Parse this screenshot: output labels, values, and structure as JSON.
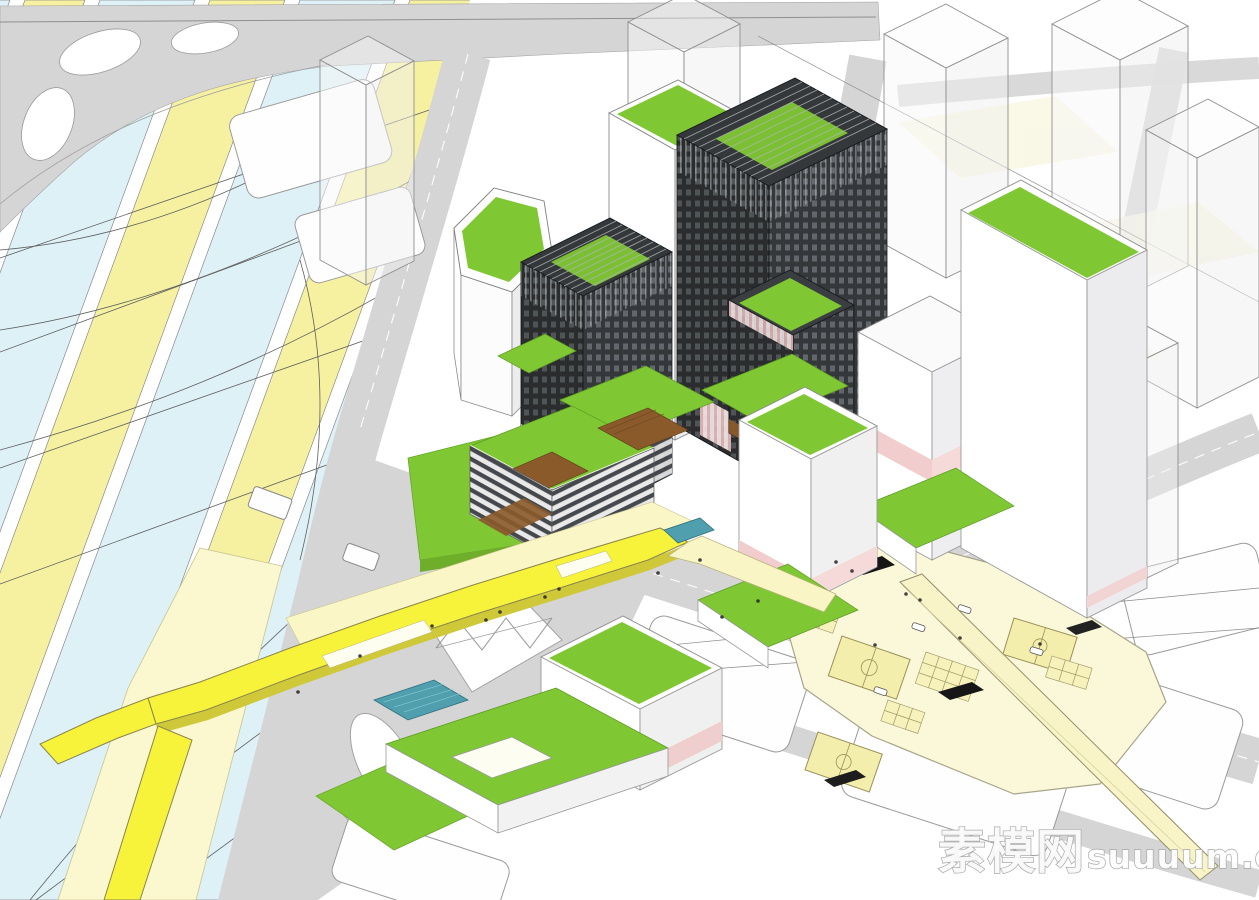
{
  "watermark": {
    "cn": "素模网",
    "en": "suuuum.com"
  },
  "palette": {
    "lawn": "#7fc733",
    "lawn_dark": "#6fae2a",
    "road": "#d5d5d5",
    "outline": "#8f8f8f",
    "band_blue": "#ddf1f6",
    "band_yellow": "#f6f1a0",
    "ramp_yellow": "#f7f23a",
    "ramp_side": "#cfc93a",
    "plaza_pale": "#fbf8da",
    "apron_pale": "#fbf8cf",
    "court_fill": "#f4eeac",
    "facade_dark": "#2a2c2e",
    "facade_dark2": "#35383b",
    "window_light": "#565a5d",
    "window_light2": "#6e7377",
    "crown_dark": "#34383a",
    "wood": "#8a5a2a",
    "pink": "#f1cdcd",
    "pink_light": "#f6dada",
    "pool": "#4f9fae",
    "white_face": "#ffffff",
    "white_shade": "#ededee"
  }
}
